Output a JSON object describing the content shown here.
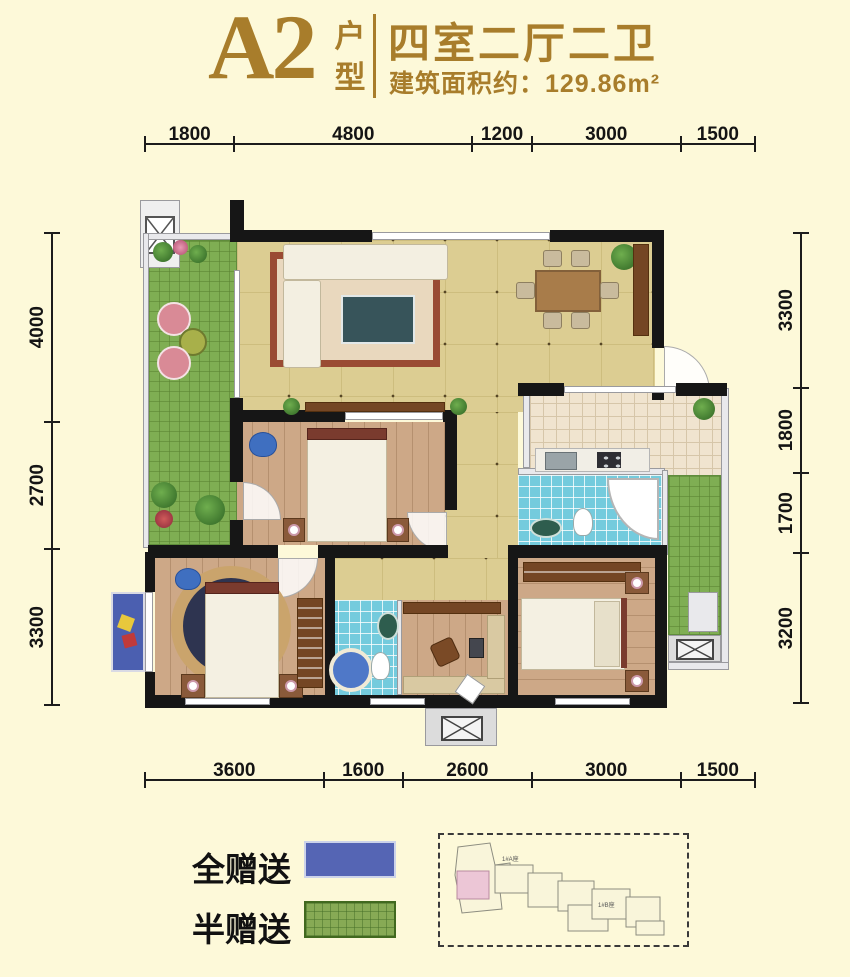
{
  "header": {
    "unit": "A2",
    "unit_type_label": "户型",
    "rooms_title": "四室二厅二卫",
    "area_text": "建筑面积约：129.86m²",
    "accent_color": "#a87d2b"
  },
  "dims": {
    "top": [
      "1800",
      "4800",
      "1200",
      "3000",
      "1500"
    ],
    "bottom": [
      "3600",
      "1600",
      "2600",
      "3000",
      "1500"
    ],
    "left": [
      "4000",
      "2700",
      "3300"
    ],
    "right": [
      "3300",
      "1800",
      "1700",
      "3200"
    ]
  },
  "legend": {
    "full_gift_label": "全赠送",
    "full_gift_color": "#5565b4",
    "half_gift_label": "半赠送",
    "half_gift_color": "#87aa55"
  },
  "keyplan": {
    "tower_a_label": "1#A座",
    "tower_b_label": "1#B座"
  }
}
